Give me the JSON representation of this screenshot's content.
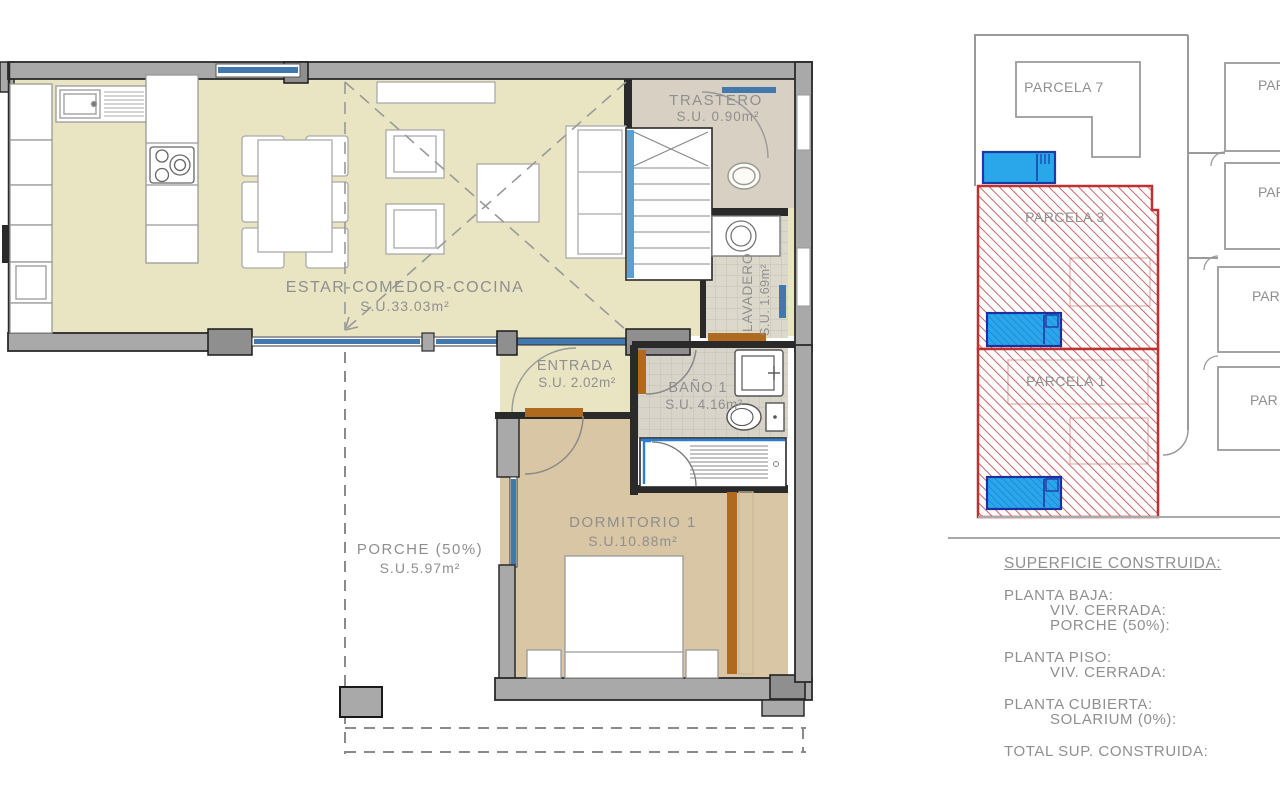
{
  "floorplan": {
    "rooms": {
      "estar": {
        "name": "ESTAR-COMEDOR-COCINA",
        "area": "S.U.33.03m²"
      },
      "trastero": {
        "name": "TRASTERO",
        "area": "S.U. 0.90m²"
      },
      "lavadero": {
        "name": "LAVADERO",
        "area": "S.U. 1.69m²"
      },
      "entrada": {
        "name": "ENTRADA",
        "area": "S.U. 2.02m²"
      },
      "bano": {
        "name": "BAÑO 1",
        "area": "S.U. 4.16m²"
      },
      "dormitorio": {
        "name": "DORMITORIO 1",
        "area": "S.U.10.88m²"
      },
      "porche": {
        "name": "PORCHE (50%)",
        "area": "S.U.5.97m²"
      }
    }
  },
  "siteplan": {
    "parcels": {
      "parcela7": "PARCELA 7",
      "parcela3": "PARCELA 3",
      "parcela1": "PARCELA 1",
      "partial1": "PAR",
      "partial2": "PAR",
      "partial3": "PAR",
      "partial4": "PAR"
    }
  },
  "legend": {
    "title": "SUPERFICIE CONSTRUIDA:",
    "planta_baja": "PLANTA BAJA:",
    "pb_viv": "VIV. CERRADA:",
    "pb_porche": "PORCHE (50%):",
    "planta_piso": "PLANTA PISO:",
    "pp_viv": "VIV. CERRADA:",
    "planta_cubierta": "PLANTA CUBIERTA:",
    "pc_solarium": "SOLARIUM (0%):",
    "total": "TOTAL SUP. CONSTRUIDA:"
  },
  "colors": {
    "floor_living": "#e9e5c3",
    "floor_bedroom": "#d9c6a4",
    "floor_store": "#d8d0c2",
    "wall_gray": "#a9a9a9",
    "wall_dark": "#2a2a2a",
    "window_blue": "#4178ad",
    "door_brown": "#b06a1e",
    "parcel_red": "#c03030",
    "pool_blue": "#29a7ea",
    "pool_border": "#1b3aa6",
    "label_gray": "#8f8f8f"
  }
}
